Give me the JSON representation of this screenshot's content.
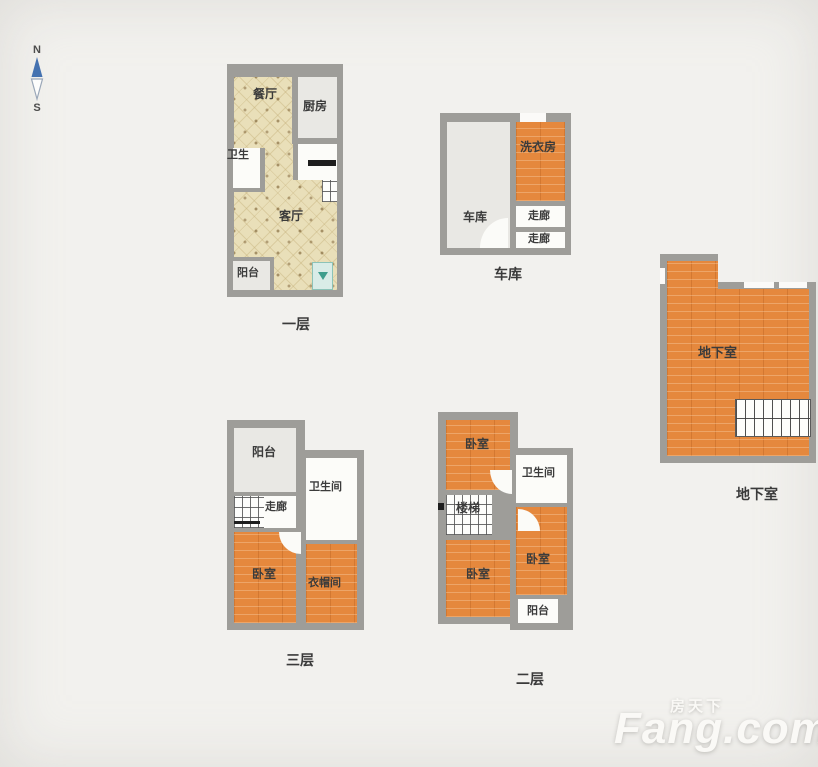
{
  "colors": {
    "background": "#f2f1ee",
    "wall": "#9e9d99",
    "floor_tan": "#e9dfb9",
    "floor_orange": "#e5883d",
    "floor_light_gray": "#e9e8e4",
    "floor_white": "#fcfcf9",
    "label_text": "#3b3b3b",
    "compass_blue": "#4472b0",
    "ac_teal": "#3f9e8d",
    "watermark": "#faf9f6"
  },
  "compass": {
    "north": "N",
    "south": "S"
  },
  "floor1": {
    "caption": "一层",
    "dining": "餐厅",
    "kitchen": "厨房",
    "bath": "卫生",
    "living": "客厅",
    "balcony": "阳台"
  },
  "garage_plan": {
    "caption": "车库",
    "garage": "车库",
    "laundry": "洗衣房",
    "corridor_a": "走廊",
    "corridor_b": "走廊"
  },
  "basement_plan": {
    "caption": "地下室",
    "room": "地下室"
  },
  "floor3": {
    "caption": "三层",
    "balcony": "阳台",
    "bath": "卫生间",
    "corridor": "走廊",
    "bedroom": "卧室",
    "closet": "衣帽间"
  },
  "floor2": {
    "caption": "二层",
    "bedroom_top": "卧室",
    "bath": "卫生间",
    "stairs": "楼梯",
    "bedroom_left": "卧室",
    "bedroom_right": "卧室",
    "balcony": "阳台"
  },
  "watermark": {
    "cn": "房天下",
    "en": "Fang.com"
  }
}
